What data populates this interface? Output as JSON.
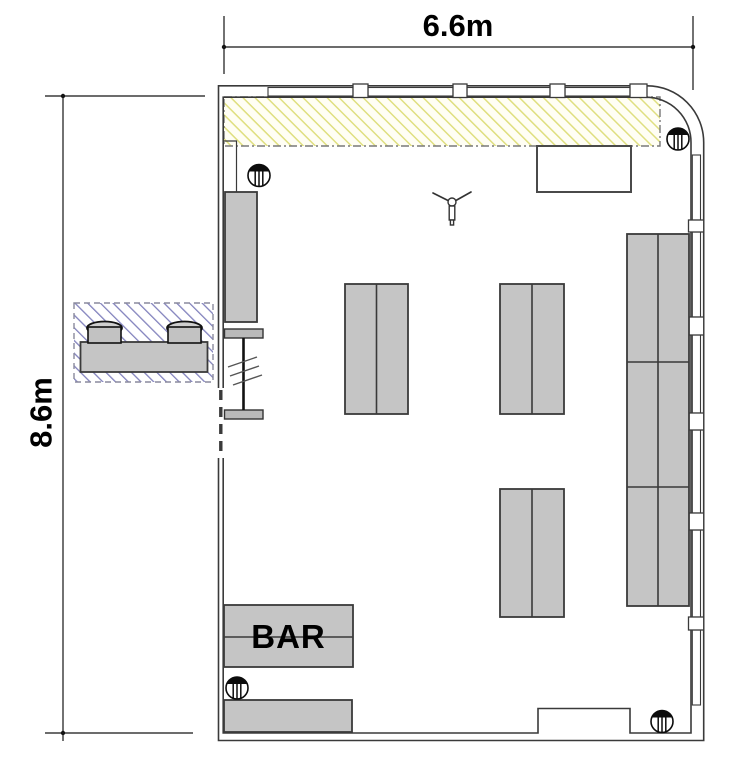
{
  "document": {
    "type": "architectural floor plan",
    "background": "#ffffff"
  },
  "dimension_annotations": {
    "width": {
      "label": "6.6m",
      "orientation": "horizontal",
      "position": "top"
    },
    "height": {
      "label": "8.6m",
      "orientation": "vertical",
      "position": "left"
    }
  },
  "room_labels": {
    "bar": "BAR"
  },
  "colors": {
    "wall_line": "#3a3a3a",
    "dim_line": "#141414",
    "label_text": "#000000",
    "furniture_fill": "#c5c5c5",
    "furniture_stroke": "#3a3a3a",
    "door_stroke": "#111111",
    "hatch_yellow_line": "#dfdf80",
    "hatch_yellow_bg": "#fffef4",
    "hatch_blue_line": "#8282bd",
    "zone_border": "#787878",
    "column_ink": "#0c0c0c",
    "window_fill": "#ffffff"
  },
  "icons": {
    "column_symbol": "circle-with-filled-cap-and-vertical-ribs",
    "ceiling_fan_symbol": "hub-with-two-angled-blades",
    "wall_break_marks": "triple-slash",
    "stool_symbol": "square-with-arched-back"
  },
  "inventory": {
    "columns": 4,
    "table_pairs": 3,
    "window_bays_top": 4,
    "window_bays_right": 6,
    "outdoor_stools": 2,
    "hatched_zones": 2
  }
}
